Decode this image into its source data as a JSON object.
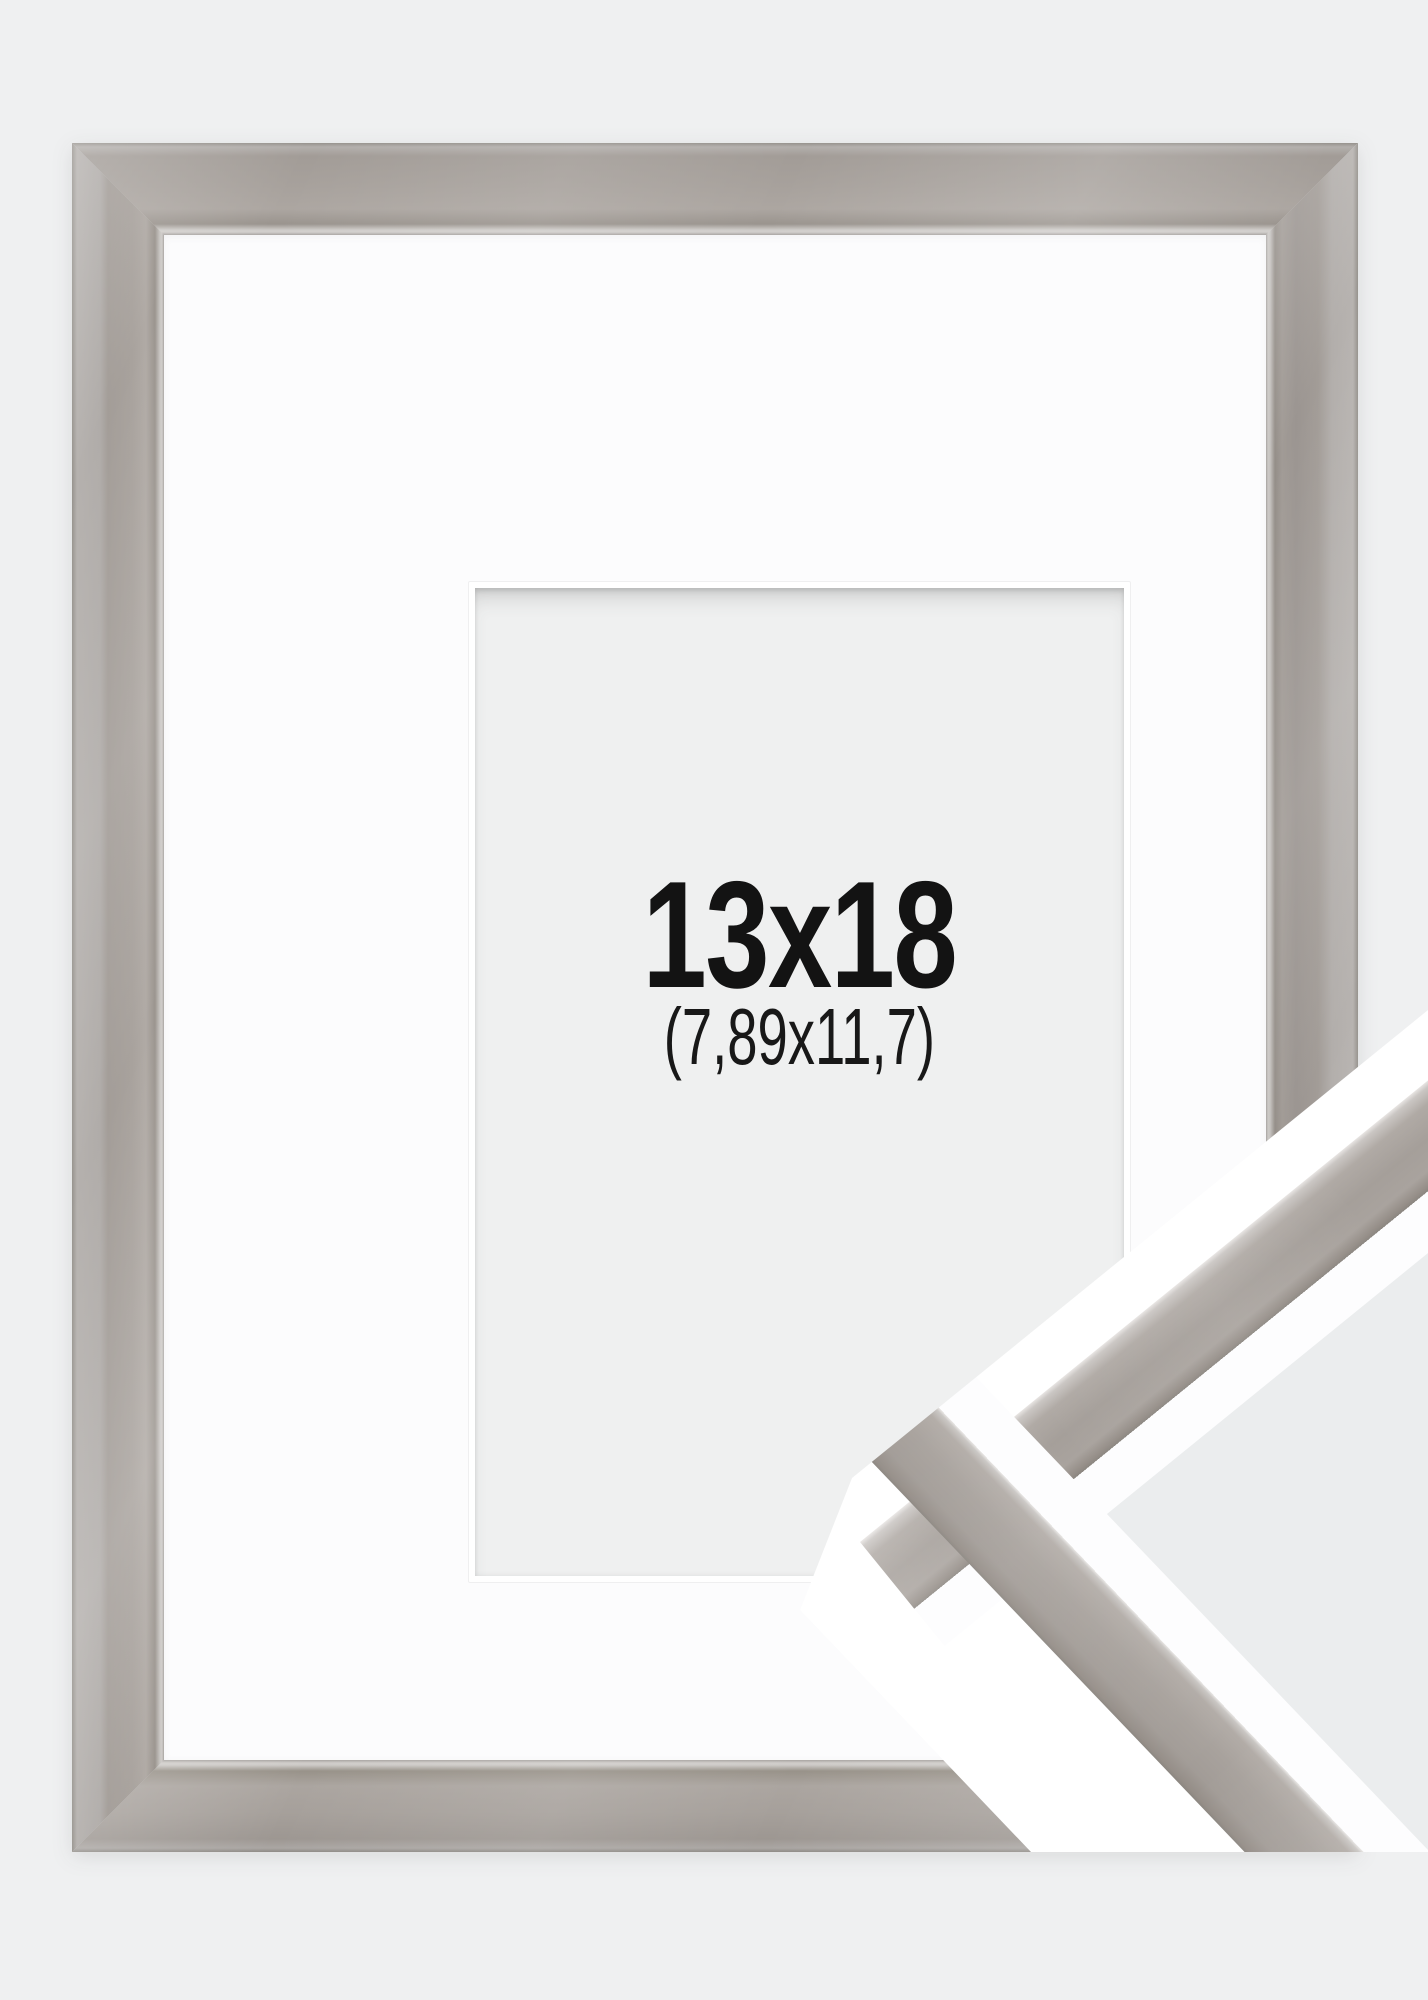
{
  "product": {
    "size_label": "13x18",
    "inner_size_label": "(7,89x11,7)"
  },
  "image": {
    "subject": "picture-frame-with-passepartout",
    "detail_view": "corner-close-up"
  },
  "colors": {
    "page_background": "#eff0f1",
    "moulding_grey": "#a8a29d",
    "moulding_highlight": "#d0cdca",
    "moulding_shadow": "#8f8a85",
    "mat_white": "#fcfcfd",
    "opening_grey": "#eff0f0",
    "text": "#131313"
  }
}
